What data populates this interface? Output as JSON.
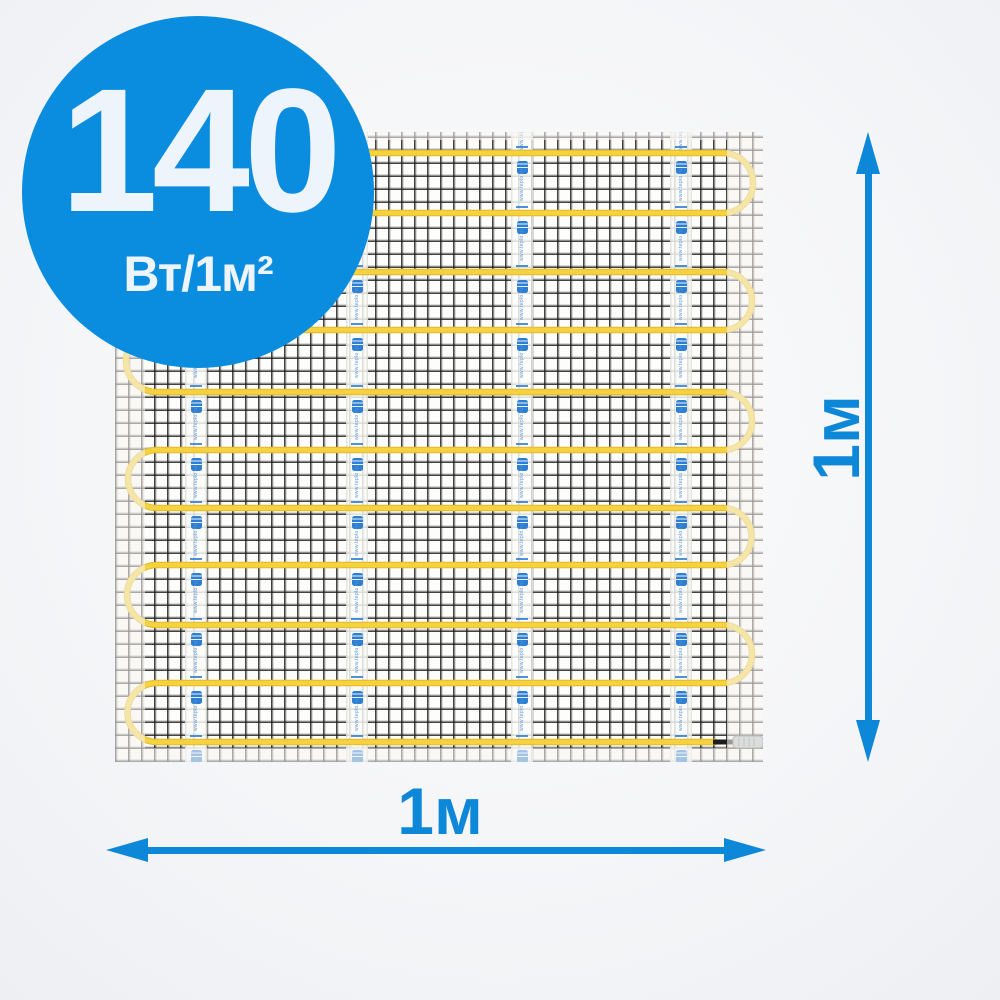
{
  "colors": {
    "badge_blue": "#0a8ddf",
    "accent_blue": "#0d87d8",
    "badge_text": "#eef4fc",
    "cable_yellow": "#f6d23e",
    "cable_shadow": "#e2b92f",
    "tape_logo_blue": "#2e7fd2",
    "connector_black": "#1d1d1d",
    "connector_sleeve": "#b5b9be"
  },
  "badge": {
    "power_value": "140",
    "power_unit": "Вт/1м²"
  },
  "dimensions": {
    "width_label": "1м",
    "height_label": "1м"
  },
  "mat": {
    "tape_text": "www.teplo.ru",
    "cable_rows_y": [
      21,
      81,
      140,
      198,
      260,
      318,
      376,
      433,
      493,
      551,
      610
    ],
    "tape_strips_x": [
      81,
      242,
      407,
      566
    ]
  }
}
